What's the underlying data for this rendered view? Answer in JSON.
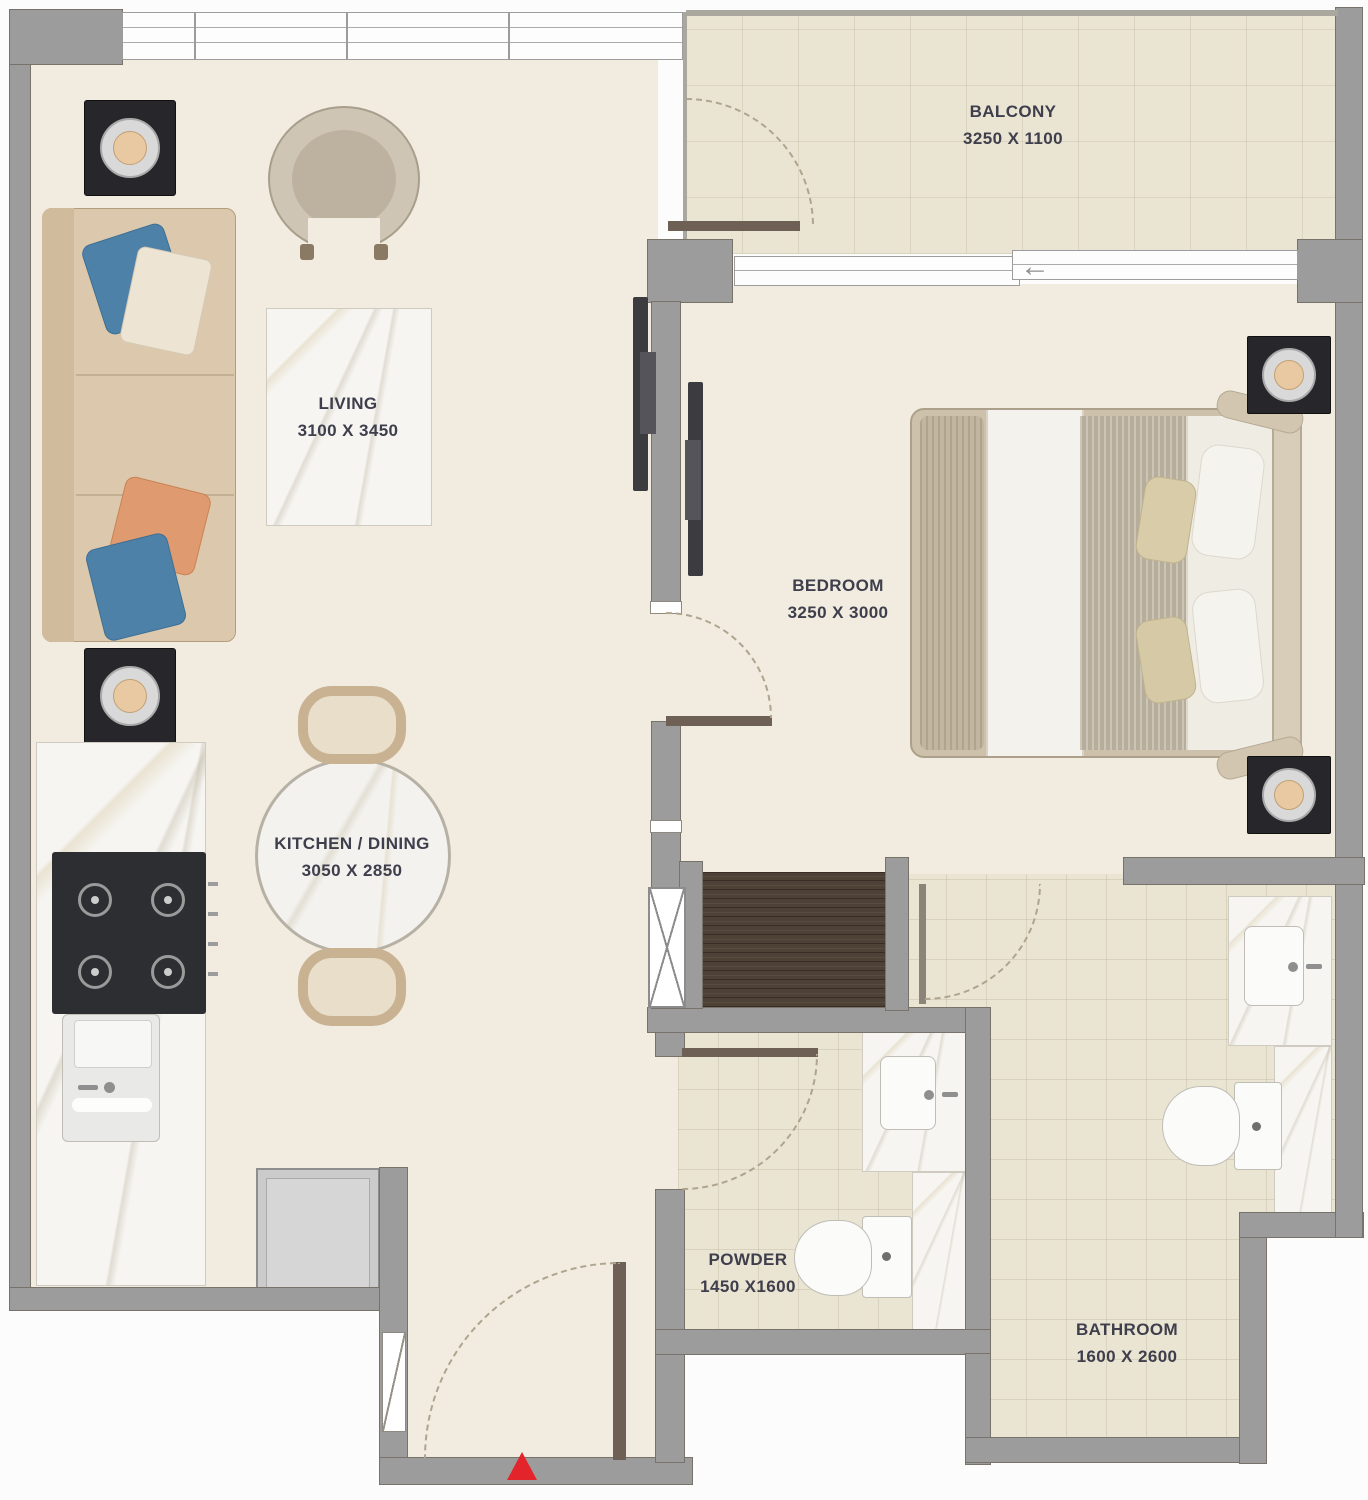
{
  "plan": {
    "rooms": {
      "living": {
        "name": "LIVING",
        "dims": "3100 X 3450"
      },
      "kitchen": {
        "name": "KITCHEN / DINING",
        "dims": "3050 X 2850"
      },
      "bedroom": {
        "name": "BEDROOM",
        "dims": "3250 X 3000"
      },
      "balcony": {
        "name": "BALCONY",
        "dims": "3250 X 1100"
      },
      "powder": {
        "name": "POWDER",
        "dims": "1450 X1600"
      },
      "bathroom": {
        "name": "BATHROOM",
        "dims": "1600 X 2600"
      }
    },
    "icons": {
      "entrance_marker": "red-triangle-up",
      "direction_arrow": "←"
    },
    "colors": {
      "wall": "#9C9C9C",
      "floor": "#F1ECDF",
      "tile": "#EAE5D2",
      "wood": "#4E4237",
      "sofa": "#DCC9AD",
      "pillow_blue": "#4E81A8",
      "pillow_orange": "#DF9B6F",
      "dark_furniture": "#26262B",
      "accent_red": "#E3252B",
      "label": "#3E3E4D"
    }
  }
}
